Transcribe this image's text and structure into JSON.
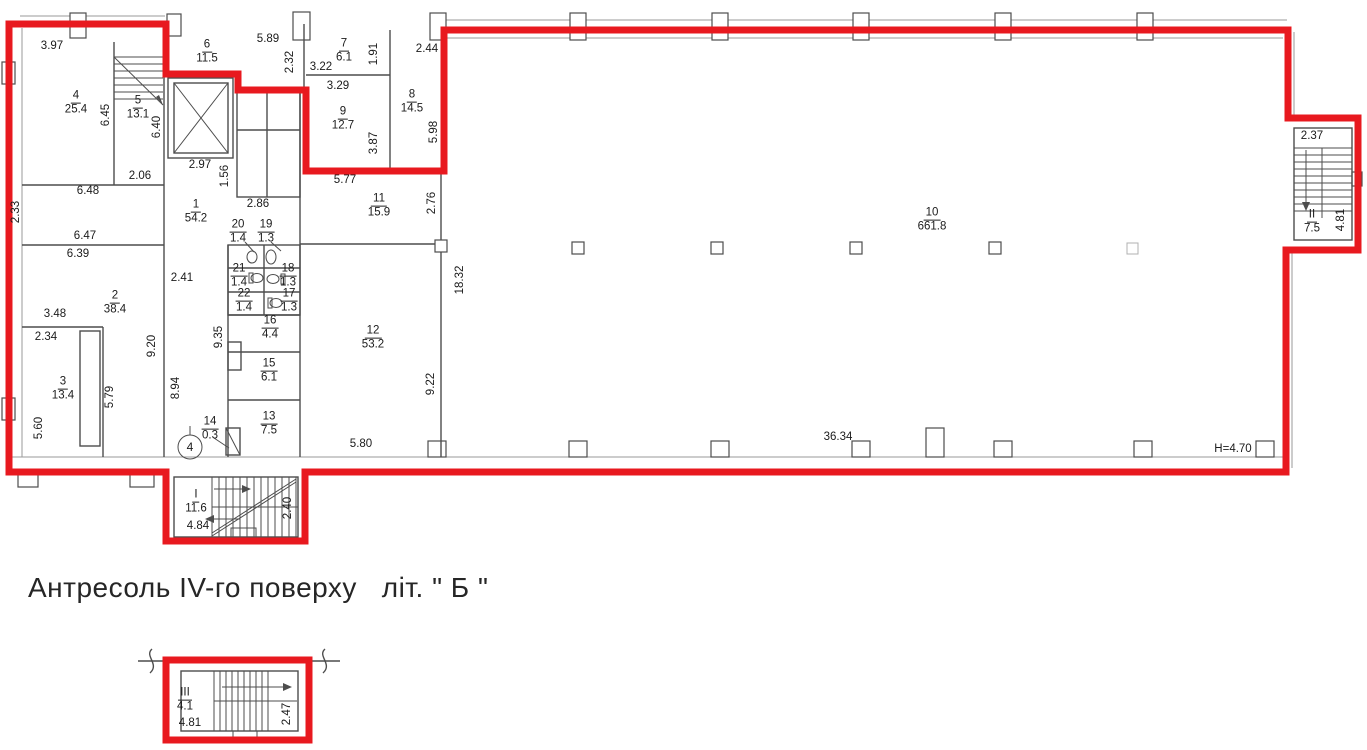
{
  "colors": {
    "outline_red": "#e8191f",
    "wall_gray": "#4d4d4d",
    "text": "#1b1b1b"
  },
  "caption": "Антресоль IV-го поверху   літ. \" Б \"",
  "marks": {
    "position_marker": "4"
  },
  "rooms": [
    {
      "n": "1",
      "a": "54.2",
      "x": 196,
      "y": 212
    },
    {
      "n": "2",
      "a": "38.4",
      "x": 115,
      "y": 303
    },
    {
      "n": "3",
      "a": "13.4",
      "x": 63,
      "y": 389
    },
    {
      "n": "4",
      "a": "25.4",
      "x": 76,
      "y": 103
    },
    {
      "n": "5",
      "a": "13.1",
      "x": 138,
      "y": 108
    },
    {
      "n": "6",
      "a": "11.5",
      "x": 207,
      "y": 52
    },
    {
      "n": "7",
      "a": "6.1",
      "x": 344,
      "y": 51
    },
    {
      "n": "8",
      "a": "14.5",
      "x": 412,
      "y": 102
    },
    {
      "n": "9",
      "a": "12.7",
      "x": 343,
      "y": 119
    },
    {
      "n": "10",
      "a": "661.8",
      "x": 932,
      "y": 220
    },
    {
      "n": "11",
      "a": "15.9",
      "x": 379,
      "y": 206
    },
    {
      "n": "12",
      "a": "53.2",
      "x": 373,
      "y": 338
    },
    {
      "n": "13",
      "a": "7.5",
      "x": 269,
      "y": 424
    },
    {
      "n": "14",
      "a": "0.3",
      "x": 210,
      "y": 429
    },
    {
      "n": "15",
      "a": "6.1",
      "x": 269,
      "y": 371
    },
    {
      "n": "16",
      "a": "4.4",
      "x": 270,
      "y": 328
    },
    {
      "n": "17",
      "a": "1.3",
      "x": 289,
      "y": 301
    },
    {
      "n": "18",
      "a": "1.3",
      "x": 288,
      "y": 276
    },
    {
      "n": "19",
      "a": "1.3",
      "x": 266,
      "y": 232
    },
    {
      "n": "20",
      "a": "1.4",
      "x": 238,
      "y": 232
    },
    {
      "n": "21",
      "a": "1.4",
      "x": 239,
      "y": 276
    },
    {
      "n": "22",
      "a": "1.4",
      "x": 244,
      "y": 301
    },
    {
      "n": "I",
      "a": "11.6",
      "x": 196,
      "y": 502
    },
    {
      "n": "II",
      "a": "7.5",
      "x": 1312,
      "y": 222
    },
    {
      "n": "III",
      "a": "4.1",
      "x": 185,
      "y": 700
    }
  ],
  "dims": [
    {
      "t": "3.97",
      "x": 52,
      "y": 46
    },
    {
      "t": "5.89",
      "x": 268,
      "y": 39
    },
    {
      "t": "2.32",
      "x": 290,
      "y": 62,
      "r": 1
    },
    {
      "t": "3.22",
      "x": 321,
      "y": 67
    },
    {
      "t": "2.44",
      "x": 427,
      "y": 49
    },
    {
      "t": "1.91",
      "x": 374,
      "y": 54,
      "r": 1
    },
    {
      "t": "3.29",
      "x": 338,
      "y": 86
    },
    {
      "t": "6.45",
      "x": 106,
      "y": 115,
      "r": 1
    },
    {
      "t": "6.40",
      "x": 157,
      "y": 127,
      "r": 1
    },
    {
      "t": "5.98",
      "x": 434,
      "y": 132,
      "r": 1
    },
    {
      "t": "3.87",
      "x": 374,
      "y": 143,
      "r": 1
    },
    {
      "t": "2.97",
      "x": 200,
      "y": 165
    },
    {
      "t": "2.06",
      "x": 140,
      "y": 176
    },
    {
      "t": "1.56",
      "x": 225,
      "y": 176,
      "r": 1
    },
    {
      "t": "6.48",
      "x": 88,
      "y": 191
    },
    {
      "t": "2.86",
      "x": 258,
      "y": 204
    },
    {
      "t": "5.77",
      "x": 345,
      "y": 180
    },
    {
      "t": "2.76",
      "x": 432,
      "y": 203,
      "r": 1
    },
    {
      "t": "2.33",
      "x": 16,
      "y": 212,
      "r": 1
    },
    {
      "t": "6.47",
      "x": 85,
      "y": 236
    },
    {
      "t": "6.39",
      "x": 78,
      "y": 254
    },
    {
      "t": "2.41",
      "x": 182,
      "y": 278
    },
    {
      "t": "18.32",
      "x": 460,
      "y": 280,
      "r": 1
    },
    {
      "t": "3.48",
      "x": 55,
      "y": 314
    },
    {
      "t": "2.34",
      "x": 46,
      "y": 337
    },
    {
      "t": "9.20",
      "x": 152,
      "y": 346,
      "r": 1
    },
    {
      "t": "9.35",
      "x": 219,
      "y": 337,
      "r": 1
    },
    {
      "t": "5.79",
      "x": 110,
      "y": 397,
      "r": 1
    },
    {
      "t": "8.94",
      "x": 176,
      "y": 388,
      "r": 1
    },
    {
      "t": "5.60",
      "x": 39,
      "y": 428,
      "r": 1
    },
    {
      "t": "9.22",
      "x": 431,
      "y": 384,
      "r": 1
    },
    {
      "t": "5.80",
      "x": 361,
      "y": 444
    },
    {
      "t": "36.34",
      "x": 838,
      "y": 437
    },
    {
      "t": "H=4.70",
      "x": 1233,
      "y": 449
    },
    {
      "t": "2.37",
      "x": 1312,
      "y": 136
    },
    {
      "t": "4.81",
      "x": 1341,
      "y": 220,
      "r": 1
    },
    {
      "t": "4.84",
      "x": 198,
      "y": 526
    },
    {
      "t": "2.40",
      "x": 288,
      "y": 508,
      "r": 1
    },
    {
      "t": "4.81",
      "x": 190,
      "y": 723
    },
    {
      "t": "2.47",
      "x": 287,
      "y": 714,
      "r": 1
    }
  ]
}
